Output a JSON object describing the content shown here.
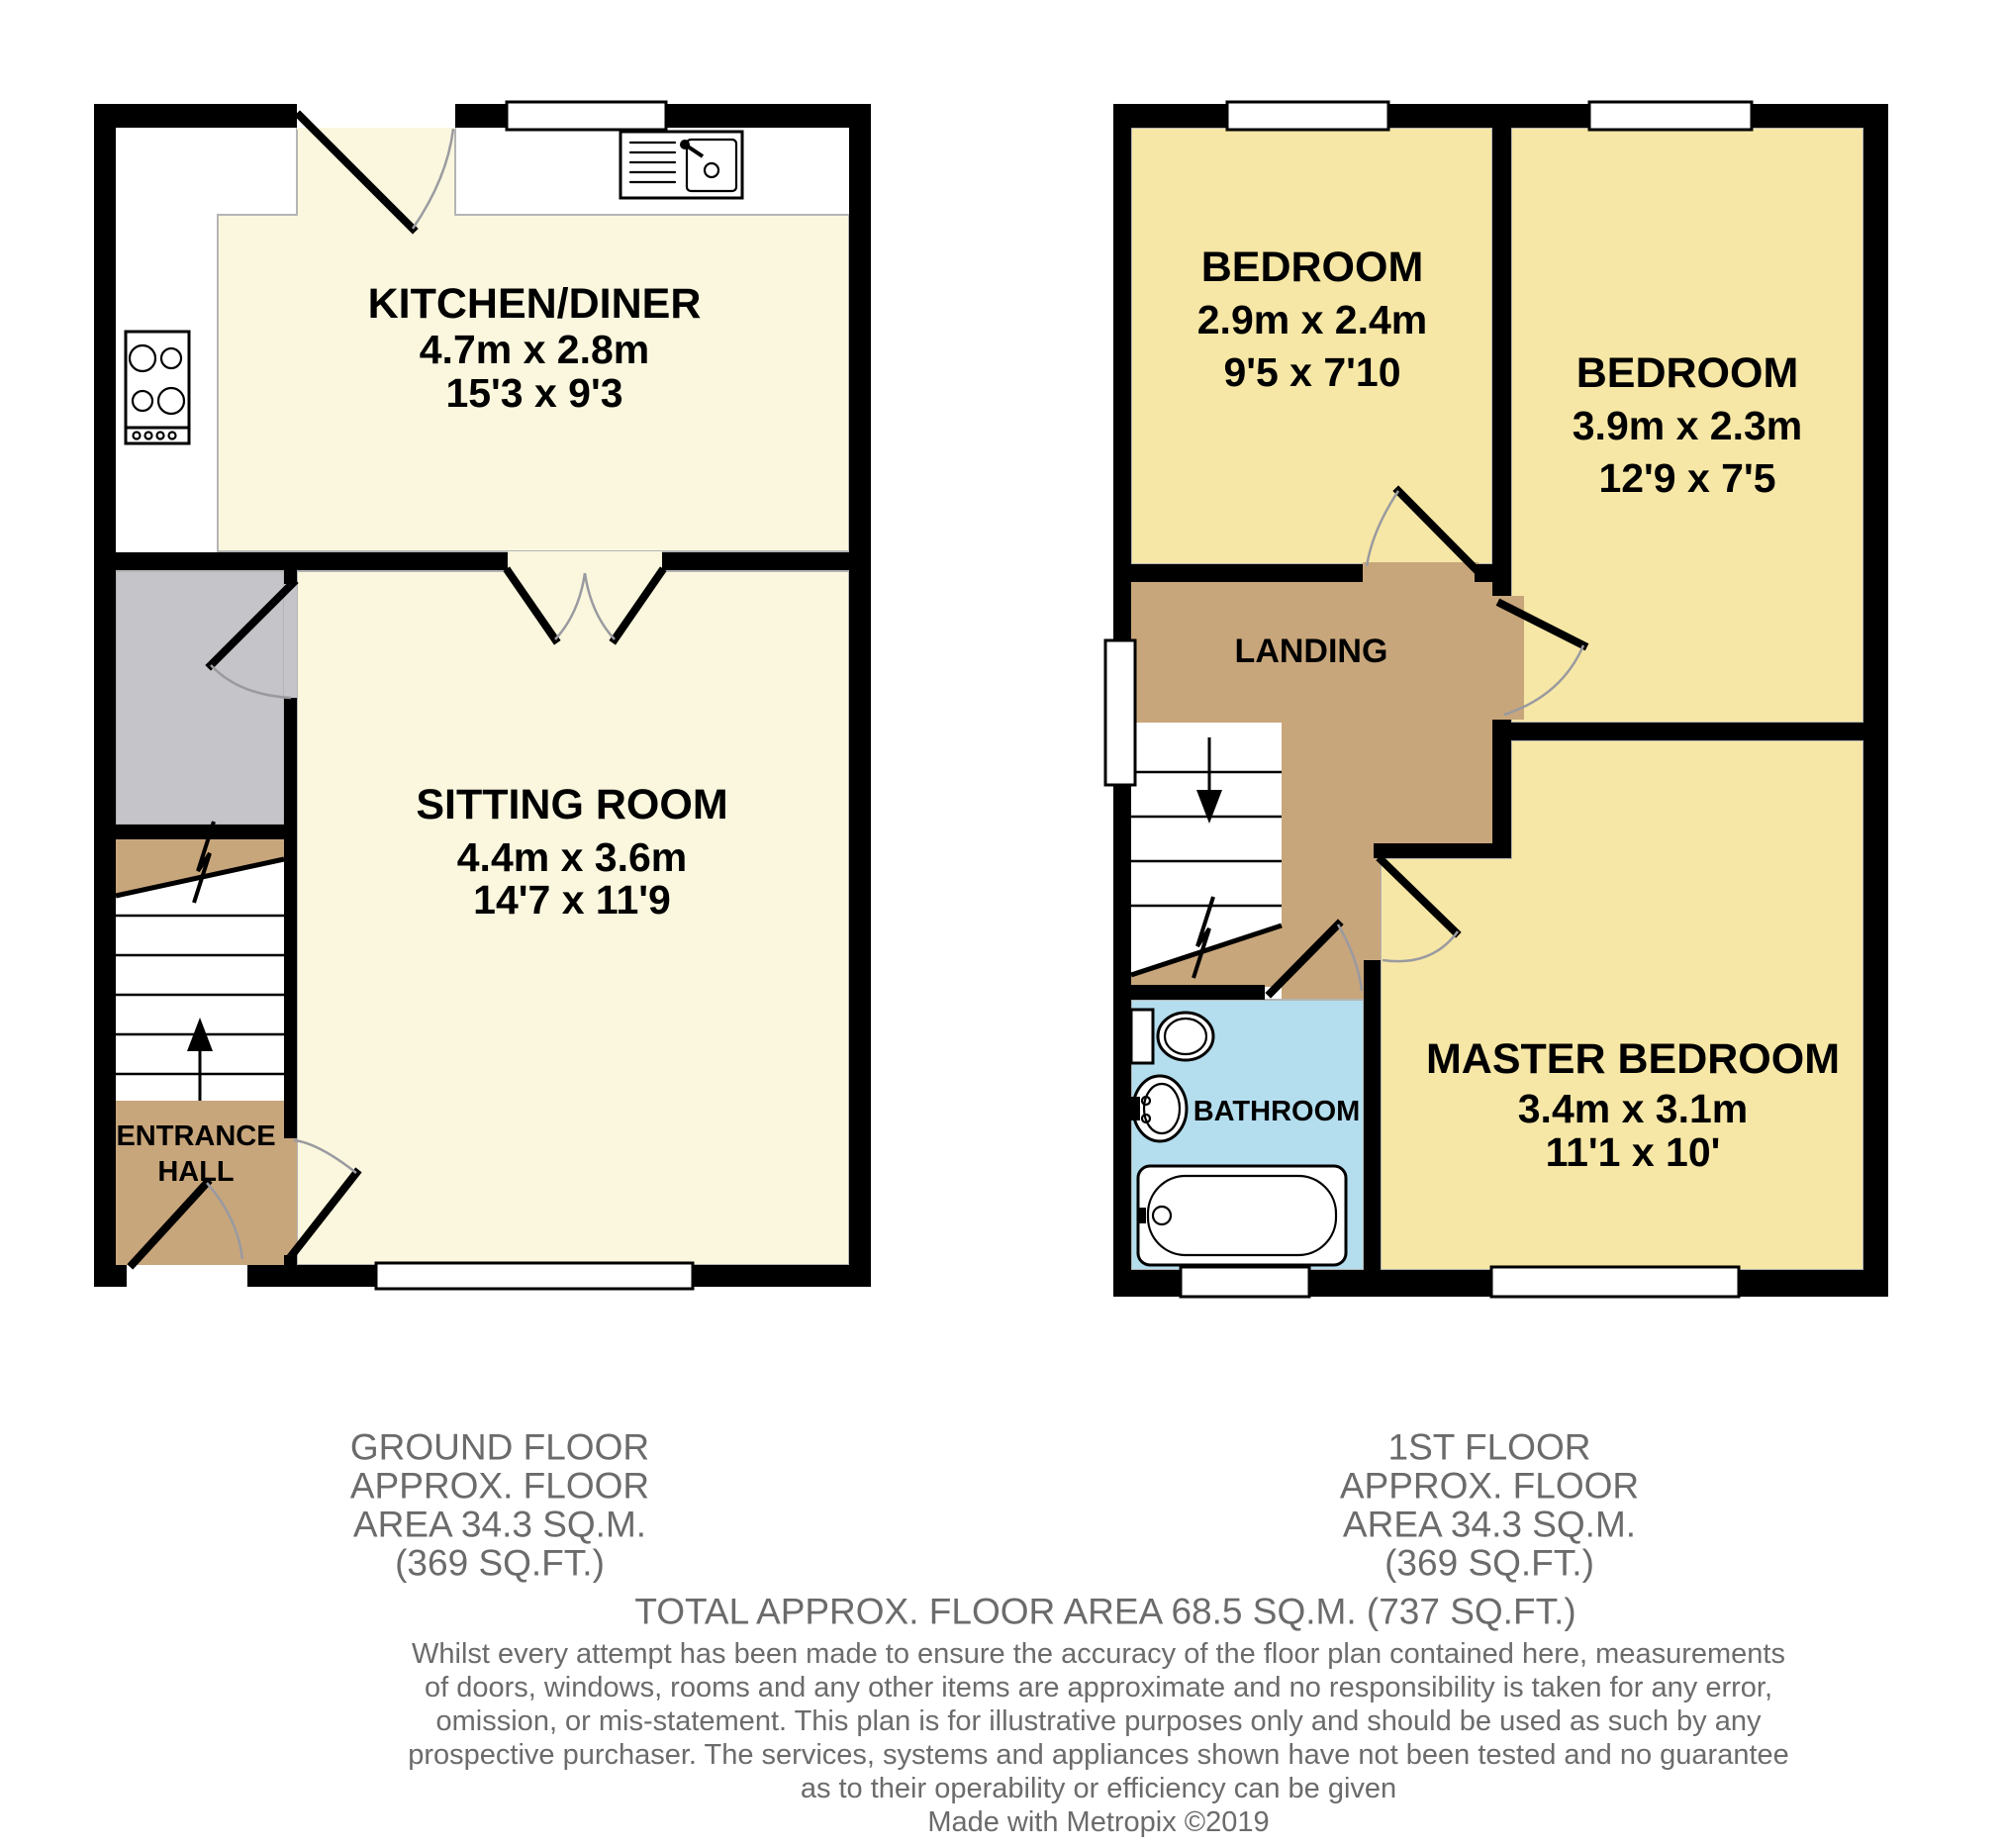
{
  "ground_floor": {
    "kitchen": {
      "name": "KITCHEN/DINER",
      "metric": "4.7m x 2.8m",
      "imperial": "15'3 x 9'3"
    },
    "sitting": {
      "name": "SITTING ROOM",
      "metric": "4.4m x 3.6m",
      "imperial": "14'7 x 11'9"
    },
    "entrance": {
      "line1": "ENTRANCE",
      "line2": "HALL"
    },
    "footer": [
      "GROUND FLOOR",
      "APPROX. FLOOR",
      "AREA 34.3 SQ.M.",
      "(369 SQ.FT.)"
    ]
  },
  "first_floor": {
    "bedroom1": {
      "name": "BEDROOM",
      "metric": "2.9m x 2.4m",
      "imperial": "9'5 x 7'10"
    },
    "bedroom2": {
      "name": "BEDROOM",
      "metric": "3.9m x 2.3m",
      "imperial": "12'9 x 7'5"
    },
    "master": {
      "name": "MASTER BEDROOM",
      "metric": "3.4m x 3.1m",
      "imperial": "11'1 x 10'"
    },
    "landing": {
      "name": "LANDING"
    },
    "bathroom": {
      "name": "BATHROOM"
    },
    "footer": [
      "1ST FLOOR",
      "APPROX. FLOOR",
      "AREA 34.3 SQ.M.",
      "(369 SQ.FT.)"
    ]
  },
  "total_line": "TOTAL APPROX. FLOOR AREA 68.5 SQ.M. (737 SQ.FT.)",
  "disclaimer": [
    "Whilst every attempt has been made to ensure the accuracy of the floor plan contained here, measurements",
    "of doors, windows, rooms and any other items are approximate and no responsibility is taken for any error,",
    "omission, or mis-statement. This plan is for illustrative purposes only and should be used as such by any",
    "prospective purchaser. The services, systems and appliances shown have not been tested and no guarantee",
    "as to their operability or efficiency can be given",
    "Made with Metropix ©2019"
  ],
  "colors": {
    "cream": "#FAF7DE",
    "bedroom_yellow": "#F6E7A6",
    "hall_tan": "#C8A67B",
    "store_gray": "#C5C4C8",
    "bathroom_blue": "#B4DEEE",
    "wall": "#000000",
    "footer_text": "#6B6B6B"
  }
}
